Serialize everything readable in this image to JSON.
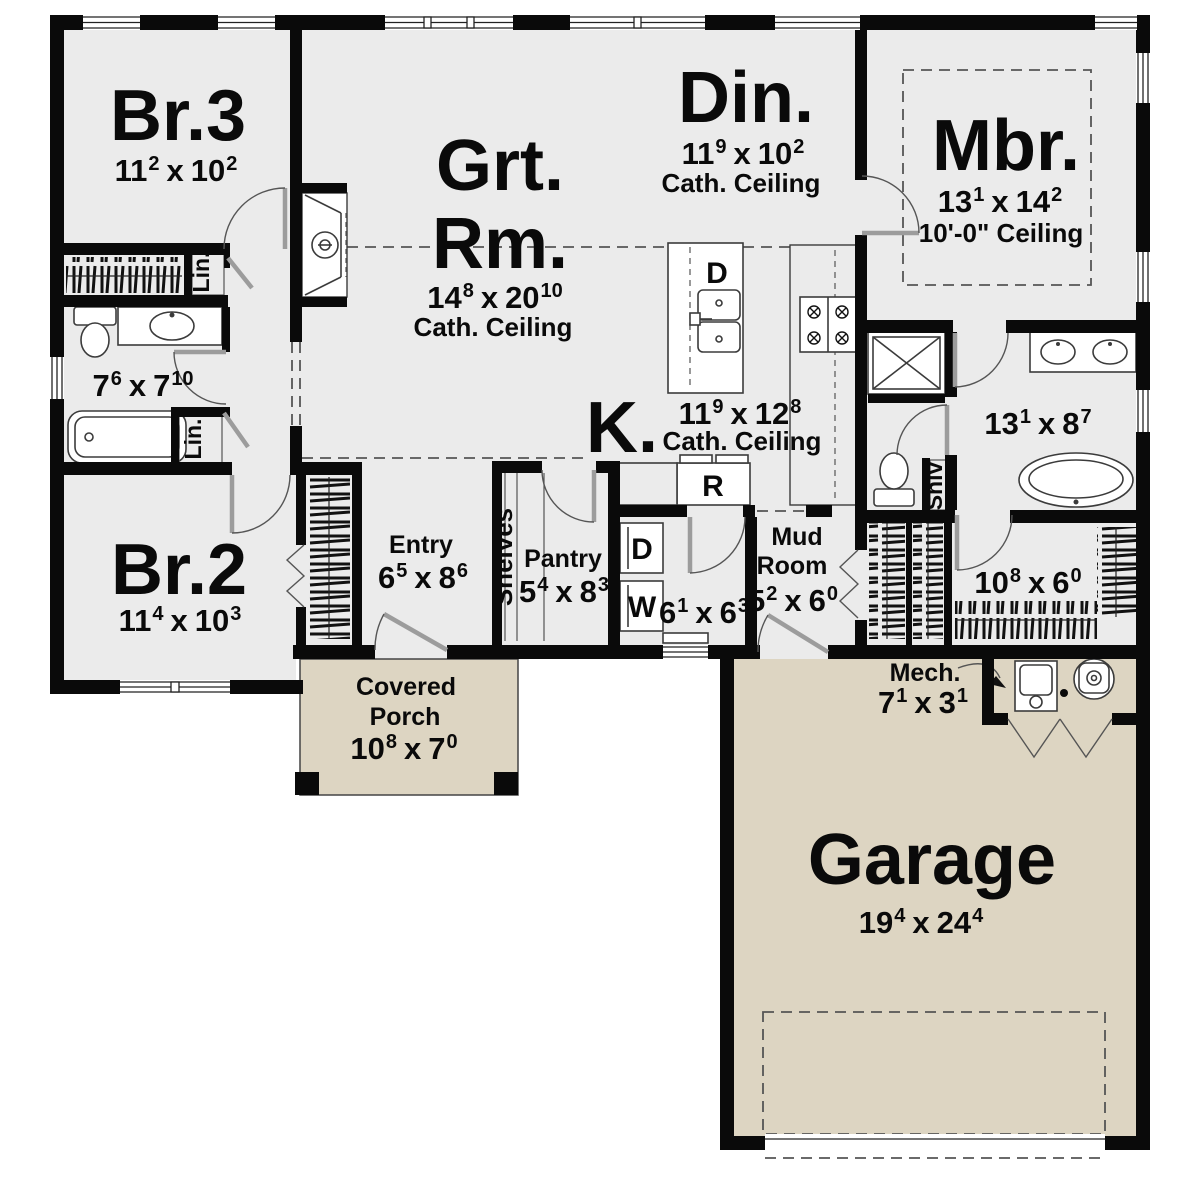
{
  "rooms": {
    "br3": {
      "name": "Br.3",
      "dim": {
        "d1": "11",
        "s1": "2",
        "sep": "x",
        "d2": "10",
        "s2": "2"
      }
    },
    "grt": {
      "name_line1": "Grt.",
      "name_line2": "Rm.",
      "dim": {
        "d1": "14",
        "s1": "8",
        "sep": "x",
        "d2": "20",
        "s2": "10"
      },
      "ceiling": "Cath. Ceiling"
    },
    "din": {
      "name": "Din.",
      "dim": {
        "d1": "11",
        "s1": "9",
        "sep": "x",
        "d2": "10",
        "s2": "2"
      },
      "ceiling": "Cath. Ceiling"
    },
    "mbr": {
      "name": "Mbr.",
      "dim": {
        "d1": "13",
        "s1": "1",
        "sep": "x",
        "d2": "14",
        "s2": "2"
      },
      "ceiling": "10'-0\" Ceiling"
    },
    "hall_bath": {
      "dim": {
        "d1": "7",
        "s1": "6",
        "sep": "x",
        "d2": "7",
        "s2": "10"
      }
    },
    "br2": {
      "name": "Br.2",
      "dim": {
        "d1": "11",
        "s1": "4",
        "sep": "x",
        "d2": "10",
        "s2": "3"
      }
    },
    "entry": {
      "name": "Entry",
      "dim": {
        "d1": "6",
        "s1": "5",
        "sep": "x",
        "d2": "8",
        "s2": "6"
      }
    },
    "pantry": {
      "name": "Pantry",
      "dim": {
        "d1": "5",
        "s1": "4",
        "sep": "x",
        "d2": "8",
        "s2": "3"
      }
    },
    "kitchen": {
      "name": "K.",
      "dim": {
        "d1": "11",
        "s1": "9",
        "sep": "x",
        "d2": "12",
        "s2": "8"
      },
      "ceiling": "Cath. Ceiling"
    },
    "laundry": {
      "dim": {
        "d1": "6",
        "s1": "1",
        "sep": "x",
        "d2": "6",
        "s2": "3"
      }
    },
    "mud": {
      "name_line1": "Mud",
      "name_line2": "Room",
      "dim": {
        "d1": "5",
        "s1": "2",
        "sep": "x",
        "d2": "6",
        "s2": "0"
      }
    },
    "master_bath": {
      "dim": {
        "d1": "13",
        "s1": "1",
        "sep": "x",
        "d2": "8",
        "s2": "7"
      }
    },
    "wic": {
      "dim": {
        "d1": "10",
        "s1": "8",
        "sep": "x",
        "d2": "6",
        "s2": "0"
      }
    },
    "mech": {
      "name": "Mech.",
      "dim": {
        "d1": "7",
        "s1": "1",
        "sep": "x",
        "d2": "3",
        "s2": "1"
      }
    },
    "porch": {
      "name_line1": "Covered",
      "name_line2": "Porch",
      "dim": {
        "d1": "10",
        "s1": "8",
        "sep": "x",
        "d2": "7",
        "s2": "0"
      }
    },
    "garage": {
      "name": "Garage",
      "dim": {
        "d1": "19",
        "s1": "4",
        "sep": "x",
        "d2": "24",
        "s2": "4"
      }
    }
  },
  "fixtures": {
    "dishwasher": "D",
    "refrigerator": "R",
    "dryer": "D",
    "washer": "W",
    "linen1": "Lin.",
    "linen2": "Lin.",
    "shelves": "Shelves",
    "shlv": "Shlv"
  },
  "colors": {
    "wall": "#0a0a0a",
    "interior_floor": "#ebebeb",
    "outdoor_floor": "#ddd5c2",
    "fixture_line": "#3b3b3b"
  }
}
